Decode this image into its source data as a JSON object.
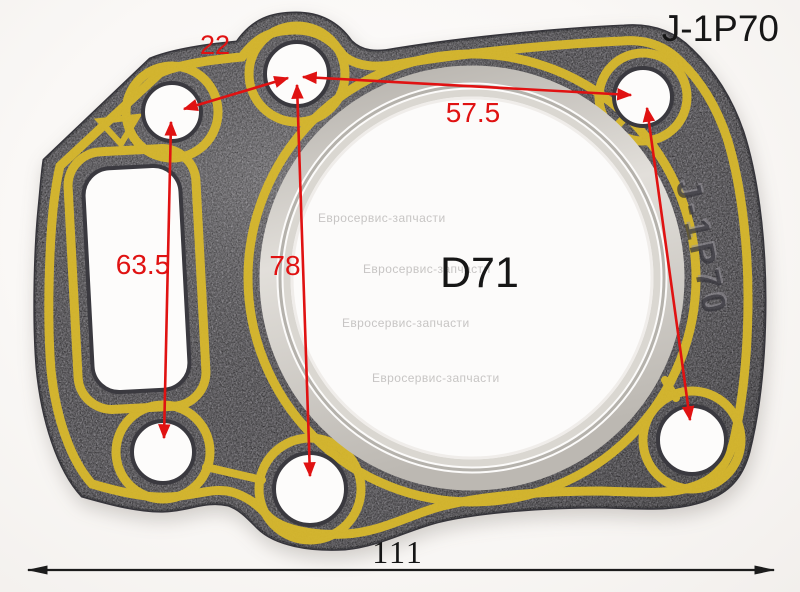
{
  "labels": {
    "product_code": "J-1P70",
    "stamp": "J-1P70",
    "bore_diameter": "D71"
  },
  "dimensions": {
    "top_left_spacing": "22",
    "top_spacing": "57.5",
    "left_height": "63.5",
    "center_height": "78",
    "overall_width": "111"
  },
  "watermarks": [
    "Евросервис-запчасти",
    "Евросервис-запчасти",
    "Евросервис-запчасти",
    "Евросервис-запчасти"
  ],
  "colors": {
    "annotation_red": "#e01212",
    "annotation_black": "#1c1c1c",
    "gasket_yellow": "#d8b92d",
    "gasket_body": "#605d63",
    "metal_ring": "#cdc9c3",
    "watermark_gray": "#c7c5c4",
    "background": "#faf8f7"
  }
}
